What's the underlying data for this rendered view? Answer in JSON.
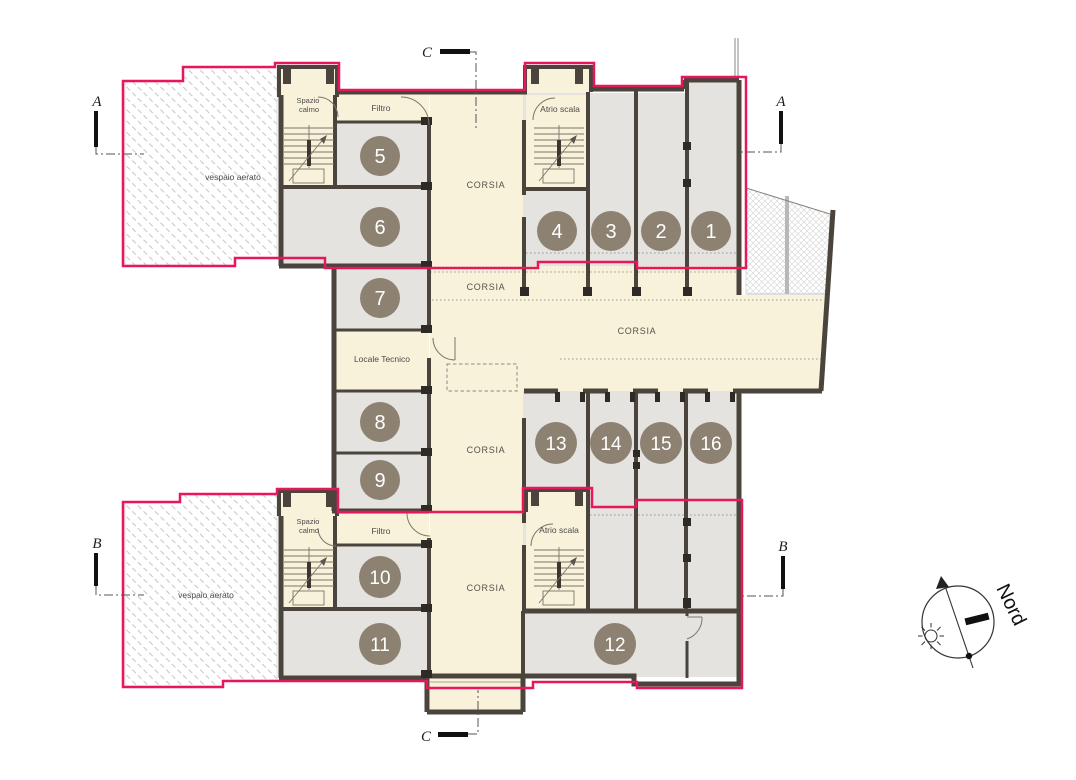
{
  "labels": {
    "corsia": "CORSIA",
    "filtro": "Filtro",
    "spazio_calmo_line1": "Spazio",
    "spazio_calmo_line2": "calmo",
    "atrio_scala": "Atrio scala",
    "locale_tecnico": "Locale Tecnico",
    "vespaio_aerato": "vespaio aerato",
    "nord": "Nord"
  },
  "rooms": {
    "numbers": [
      "1",
      "2",
      "3",
      "4",
      "5",
      "6",
      "7",
      "8",
      "9",
      "10",
      "11",
      "12",
      "13",
      "14",
      "15",
      "16"
    ]
  },
  "sections": {
    "a": "A",
    "b": "B",
    "c": "C"
  },
  "colors": {
    "pink": "#e8175c",
    "wall": "#4a443c",
    "room": "#e4e3e0",
    "corridor": "#f8f2da",
    "circle": "#8d8272",
    "hatch": "#c9c9c9"
  }
}
